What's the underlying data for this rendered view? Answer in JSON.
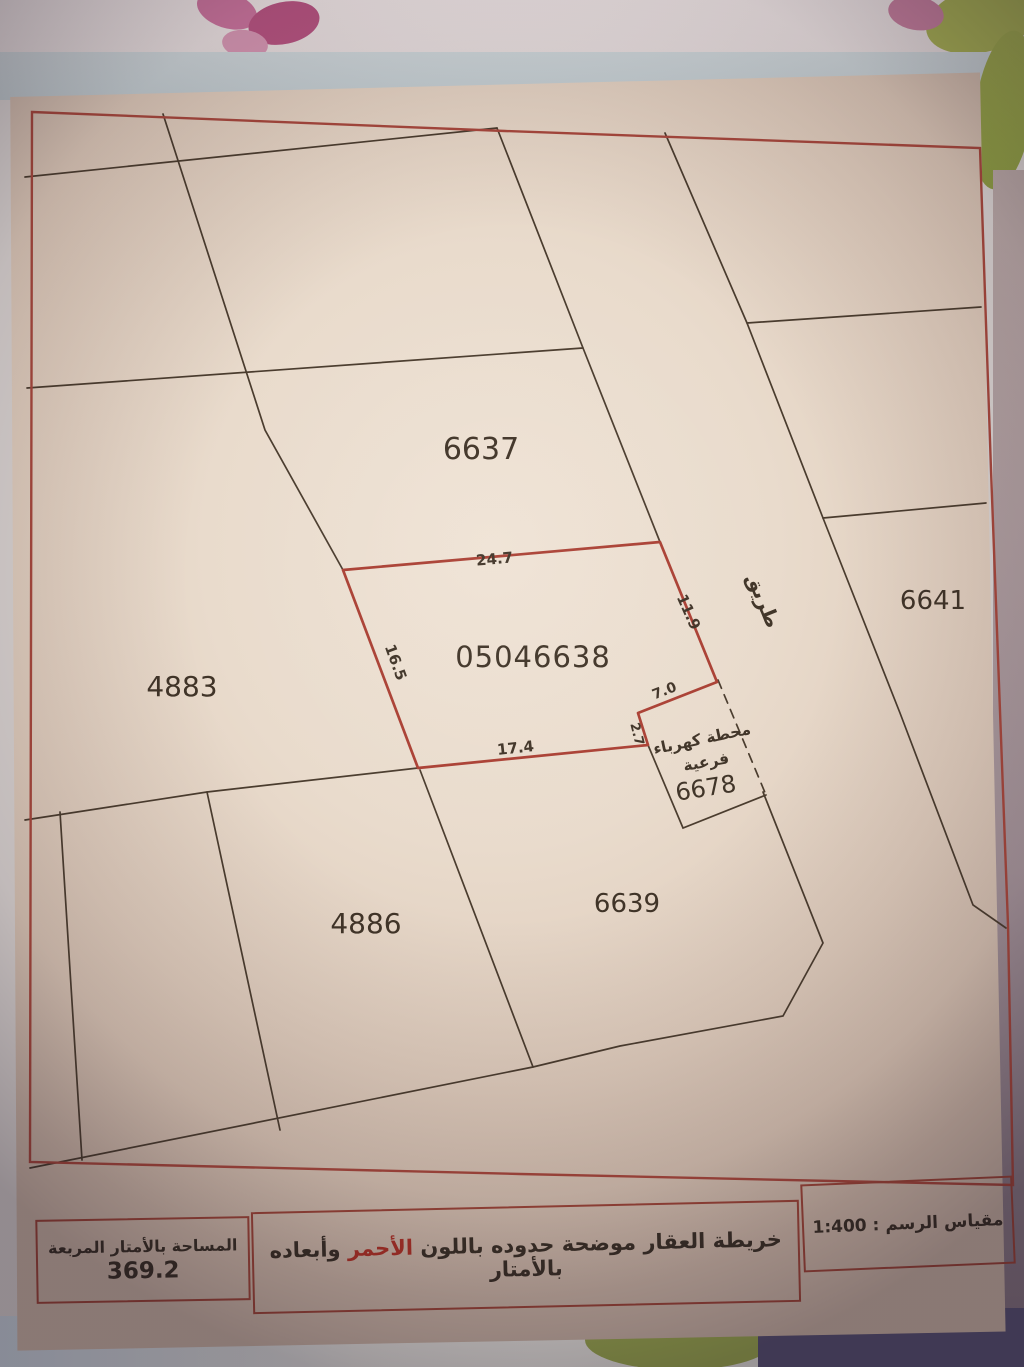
{
  "title_block": {
    "area_label": "المساحة بالأمتار المربعة",
    "area_value": "369.2",
    "title_prefix": "خريطة العقار موضحة حدوده باللون ",
    "title_red": "الأحمر",
    "title_suffix": " وأبعاده بالأمتار",
    "scale_label": "مقياس الرسم : 1:400"
  },
  "map": {
    "road_label": "طريق",
    "subject_parcel": {
      "number": "05046638",
      "dim_top": "24.7",
      "dim_right": "11.9",
      "dim_left": "16.5",
      "dim_bottom": "17.4",
      "dim_notch_top": "7.0",
      "dim_notch_side": "2.7"
    },
    "substation": {
      "label_line1": "محطة كهرباء",
      "label_line2": "فرعية",
      "number": "6678"
    },
    "parcels": {
      "n6637": "6637",
      "n6641": "6641",
      "n4883": "4883",
      "n4886": "4886",
      "n6639": "6639"
    }
  },
  "colors": {
    "red_ink": "#a6473c",
    "subject_red": "#aa4034",
    "black_ink": "#4a3c2e",
    "paper": "#e8dacb"
  }
}
